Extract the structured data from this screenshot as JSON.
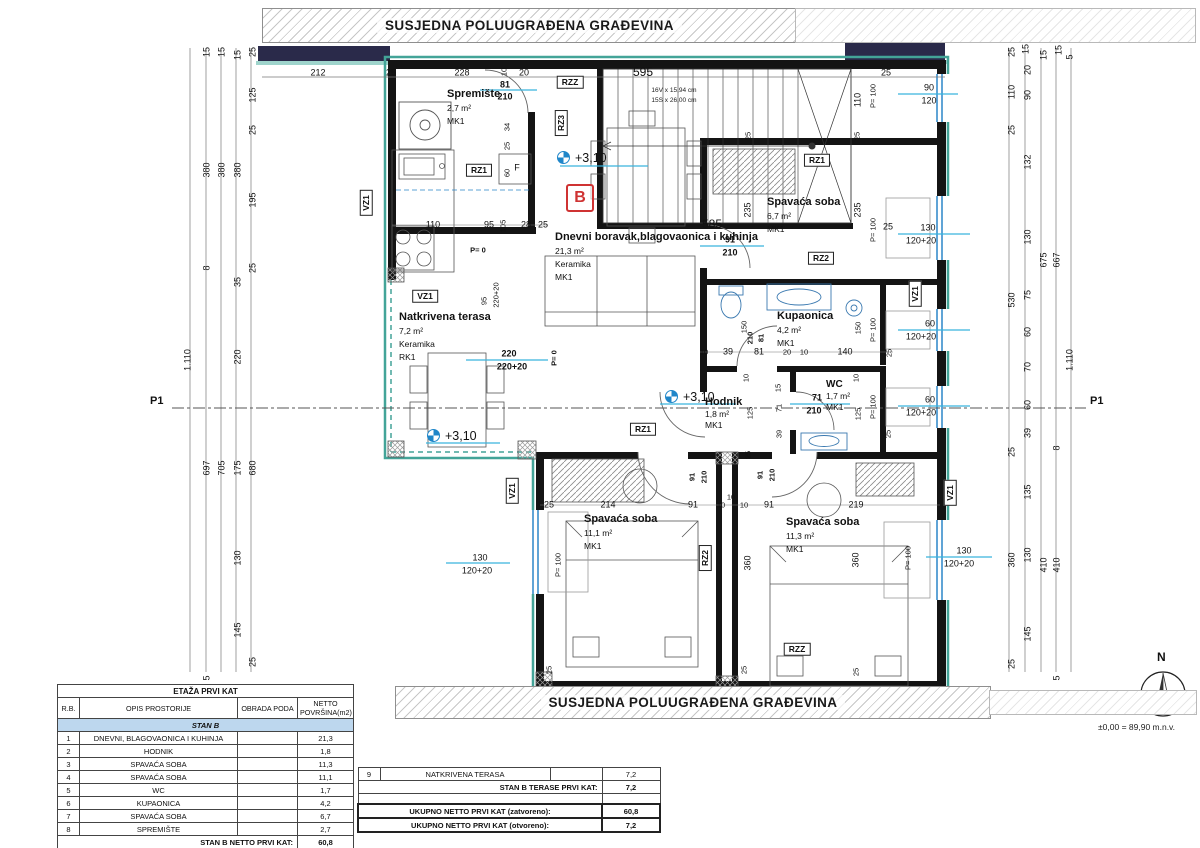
{
  "banners": {
    "top": "SUSJEDNA POLUUGRAĐENA GRAĐEVINA",
    "bottom": "SUSJEDNA POLUUGRAĐENA GRAĐEVINA"
  },
  "unit": {
    "letter": "B"
  },
  "section_marks": {
    "left": "P1",
    "right": "P1"
  },
  "levels": {
    "value": "+3,10"
  },
  "compass": {
    "label": "N",
    "elevation": "±0,00 = 89,90 m.n.v."
  },
  "stairs": {
    "flight_text1": "16V x 15,94 cm",
    "flight_text2": "15S x 26,00 cm"
  },
  "rooms": {
    "spremiste": {
      "name": "Spremište",
      "area": "2,7 m²",
      "mark": "MK1"
    },
    "dnevni": {
      "name": "Dnevni boravak,blagovaonica i kuhinja",
      "area": "21,3 m²",
      "finish": "Keramika",
      "mark": "MK1"
    },
    "spavaca67": {
      "name": "Spavaća soba",
      "area": "6,7 m²",
      "mark": "MK1"
    },
    "kupaonica": {
      "name": "Kupaonica",
      "area": "4,2 m²",
      "mark": "MK1"
    },
    "wc": {
      "name": "WC",
      "area": "1,7 m²",
      "mark": "MK1"
    },
    "hodnik": {
      "name": "Hodnik",
      "area": "1,8 m²",
      "mark": "MK1"
    },
    "spavaca111": {
      "name": "Spavaća soba",
      "area": "11,1 m²",
      "mark": "MK1"
    },
    "spavaca113": {
      "name": "Spavaća soba",
      "area": "11,3 m²",
      "mark": "MK1"
    },
    "terasa": {
      "name": "Natkrivena terasa",
      "area": "7,2 m²",
      "finish": "Keramika",
      "mark": "RK1"
    }
  },
  "tables": {
    "area_table": {
      "title": "ETAŽA PRVI KAT",
      "headers": [
        "R.B.",
        "OPIS PROSTORIJE",
        "OBRADA PODA",
        "NETTO POVRŠINA(m2)"
      ],
      "section_row": "STAN B",
      "rows": [
        [
          "1",
          "DNEVNI, BLAGOVAONICA I KUHINJA",
          "",
          "21,3"
        ],
        [
          "2",
          "HODNIK",
          "",
          "1,8"
        ],
        [
          "3",
          "SPAVAĆA SOBA",
          "",
          "11,3"
        ],
        [
          "4",
          "SPAVAĆA SOBA",
          "",
          "11,1"
        ],
        [
          "5",
          "WC",
          "",
          "1,7"
        ],
        [
          "6",
          "KUPAONICA",
          "",
          "4,2"
        ],
        [
          "7",
          "SPAVAĆA SOBA",
          "",
          "6,7"
        ],
        [
          "8",
          "SPREMIŠTE",
          "",
          "2,7"
        ]
      ],
      "total_label": "STAN B NETTO PRVI KAT:",
      "total_value": "60,8"
    },
    "terrace_table": {
      "row9": [
        "9",
        "NATKRIVENA TERASA",
        "",
        "7,2"
      ],
      "terase_label": "STAN B TERASE PRVI KAT:",
      "terase_value": "7,2",
      "zatvoreno_label": "UKUPNO NETTO PRVI KAT (zatvoreno):",
      "zatvoreno_value": "60,8",
      "otvoreno_label": "UKUPNO NETTO PRVI KAT (otvoreno):",
      "otvoreno_value": "7,2"
    }
  },
  "dims": [
    {
      "t": "212",
      "x": 318,
      "y": 73
    },
    {
      "t": "25",
      "x": 391,
      "y": 73
    },
    {
      "t": "228",
      "x": 462,
      "y": 73
    },
    {
      "t": "20",
      "x": 524,
      "y": 73
    },
    {
      "t": "595",
      "x": 643,
      "y": 72,
      "c": "lg"
    },
    {
      "t": "25",
      "x": 886,
      "y": 73
    },
    {
      "t": "90",
      "x": 929,
      "y": 88
    },
    {
      "t": "120",
      "x": 929,
      "y": 101
    },
    {
      "t": "110",
      "x": 858,
      "y": 100,
      "r": 1
    },
    {
      "t": "P= 100",
      "x": 873,
      "y": 96,
      "r": 1,
      "c": "sm"
    },
    {
      "t": "81",
      "x": 505,
      "y": 85,
      "b": 1
    },
    {
      "t": "210",
      "x": 505,
      "y": 97,
      "b": 1
    },
    {
      "t": "10",
      "x": 504,
      "y": 72,
      "r": 1,
      "c": "sm"
    },
    {
      "t": "34",
      "x": 507,
      "y": 127,
      "r": 1,
      "c": "sm"
    },
    {
      "t": "25",
      "x": 507,
      "y": 146,
      "r": 1,
      "c": "sm"
    },
    {
      "t": "60",
      "x": 507,
      "y": 173,
      "r": 1,
      "c": "sm"
    },
    {
      "t": "15",
      "x": 207,
      "y": 52,
      "r": 1
    },
    {
      "t": "15",
      "x": 222,
      "y": 52,
      "r": 1
    },
    {
      "t": "15",
      "x": 238,
      "y": 55,
      "r": 1
    },
    {
      "t": "25",
      "x": 253,
      "y": 52,
      "r": 1
    },
    {
      "t": "125",
      "x": 253,
      "y": 95,
      "r": 1
    },
    {
      "t": "25",
      "x": 253,
      "y": 130,
      "r": 1
    },
    {
      "t": "380",
      "x": 207,
      "y": 170,
      "r": 1
    },
    {
      "t": "380",
      "x": 222,
      "y": 170,
      "r": 1
    },
    {
      "t": "380",
      "x": 238,
      "y": 170,
      "r": 1
    },
    {
      "t": "195",
      "x": 253,
      "y": 200,
      "r": 1
    },
    {
      "t": "25",
      "x": 253,
      "y": 268,
      "r": 1
    },
    {
      "t": "8",
      "x": 207,
      "y": 268,
      "r": 1
    },
    {
      "t": "35",
      "x": 238,
      "y": 282,
      "r": 1
    },
    {
      "t": "220",
      "x": 238,
      "y": 357,
      "r": 1
    },
    {
      "t": "1.110",
      "x": 188,
      "y": 360,
      "r": 1
    },
    {
      "t": "697",
      "x": 207,
      "y": 468,
      "r": 1
    },
    {
      "t": "705",
      "x": 222,
      "y": 468,
      "r": 1
    },
    {
      "t": "175",
      "x": 238,
      "y": 468,
      "r": 1
    },
    {
      "t": "680",
      "x": 253,
      "y": 468,
      "r": 1
    },
    {
      "t": "130",
      "x": 238,
      "y": 558,
      "r": 1
    },
    {
      "t": "145",
      "x": 238,
      "y": 630,
      "r": 1
    },
    {
      "t": "25",
      "x": 253,
      "y": 662,
      "r": 1
    },
    {
      "t": "5",
      "x": 207,
      "y": 678,
      "r": 1
    },
    {
      "t": "25",
      "x": 1012,
      "y": 52,
      "r": 1
    },
    {
      "t": "15",
      "x": 1026,
      "y": 49,
      "r": 1
    },
    {
      "t": "20",
      "x": 1028,
      "y": 70,
      "r": 1
    },
    {
      "t": "15",
      "x": 1044,
      "y": 55,
      "r": 1
    },
    {
      "t": "15",
      "x": 1059,
      "y": 50,
      "r": 1
    },
    {
      "t": "5",
      "x": 1070,
      "y": 57,
      "r": 1
    },
    {
      "t": "110",
      "x": 1012,
      "y": 92,
      "r": 1
    },
    {
      "t": "90",
      "x": 1028,
      "y": 95,
      "r": 1
    },
    {
      "t": "25",
      "x": 1012,
      "y": 130,
      "r": 1
    },
    {
      "t": "132",
      "x": 1028,
      "y": 162,
      "r": 1
    },
    {
      "t": "130",
      "x": 1028,
      "y": 237,
      "r": 1
    },
    {
      "t": "675",
      "x": 1044,
      "y": 260,
      "r": 1
    },
    {
      "t": "667",
      "x": 1057,
      "y": 260,
      "r": 1
    },
    {
      "t": "530",
      "x": 1012,
      "y": 300,
      "r": 1
    },
    {
      "t": "75",
      "x": 1028,
      "y": 295,
      "r": 1
    },
    {
      "t": "60",
      "x": 1028,
      "y": 332,
      "r": 1
    },
    {
      "t": "70",
      "x": 1028,
      "y": 367,
      "r": 1
    },
    {
      "t": "60",
      "x": 1028,
      "y": 405,
      "r": 1
    },
    {
      "t": "1.110",
      "x": 1070,
      "y": 360,
      "r": 1
    },
    {
      "t": "39",
      "x": 1028,
      "y": 433,
      "r": 1
    },
    {
      "t": "25",
      "x": 1012,
      "y": 452,
      "r": 1
    },
    {
      "t": "8",
      "x": 1057,
      "y": 448,
      "r": 1
    },
    {
      "t": "135",
      "x": 1028,
      "y": 492,
      "r": 1
    },
    {
      "t": "360",
      "x": 1012,
      "y": 560,
      "r": 1
    },
    {
      "t": "130",
      "x": 1028,
      "y": 555,
      "r": 1
    },
    {
      "t": "410",
      "x": 1044,
      "y": 565,
      "r": 1
    },
    {
      "t": "410",
      "x": 1057,
      "y": 565,
      "r": 1
    },
    {
      "t": "145",
      "x": 1028,
      "y": 634,
      "r": 1
    },
    {
      "t": "25",
      "x": 1012,
      "y": 664,
      "r": 1
    },
    {
      "t": "5",
      "x": 1057,
      "y": 678,
      "r": 1
    },
    {
      "t": "110",
      "x": 433,
      "y": 225
    },
    {
      "t": "95",
      "x": 489,
      "y": 225
    },
    {
      "t": "105",
      "x": 503,
      "y": 226,
      "r": 1,
      "c": "sm"
    },
    {
      "t": "28",
      "x": 526,
      "y": 225
    },
    {
      "t": "25",
      "x": 543,
      "y": 225
    },
    {
      "t": "P= 0",
      "x": 478,
      "y": 250,
      "b": 1,
      "c": "sm"
    },
    {
      "t": "95",
      "x": 484,
      "y": 301,
      "r": 1,
      "c": "sm"
    },
    {
      "t": "220+20",
      "x": 496,
      "y": 295,
      "r": 1,
      "c": "sm"
    },
    {
      "t": "585",
      "x": 712,
      "y": 224,
      "c": "lg"
    },
    {
      "t": "91",
      "x": 730,
      "y": 240,
      "b": 1
    },
    {
      "t": "210",
      "x": 730,
      "y": 253,
      "b": 1
    },
    {
      "t": "25",
      "x": 748,
      "y": 136,
      "r": 1,
      "c": "sm"
    },
    {
      "t": "25",
      "x": 857,
      "y": 136,
      "r": 1,
      "c": "sm"
    },
    {
      "t": "235",
      "x": 748,
      "y": 210,
      "r": 1
    },
    {
      "t": "235",
      "x": 858,
      "y": 210,
      "r": 1
    },
    {
      "t": "P= 100",
      "x": 873,
      "y": 230,
      "r": 1,
      "c": "sm"
    },
    {
      "t": "25",
      "x": 888,
      "y": 227
    },
    {
      "t": "130",
      "x": 928,
      "y": 228
    },
    {
      "t": "120+20",
      "x": 921,
      "y": 241
    },
    {
      "t": "10",
      "x": 704,
      "y": 352,
      "c": "sm"
    },
    {
      "t": "39",
      "x": 728,
      "y": 352
    },
    {
      "t": "81",
      "x": 759,
      "y": 352
    },
    {
      "t": "20",
      "x": 787,
      "y": 352,
      "c": "sm"
    },
    {
      "t": "10",
      "x": 804,
      "y": 352,
      "c": "sm"
    },
    {
      "t": "140",
      "x": 845,
      "y": 352
    },
    {
      "t": "25",
      "x": 889,
      "y": 353,
      "r": 1,
      "c": "sm"
    },
    {
      "t": "150",
      "x": 744,
      "y": 327,
      "r": 1,
      "c": "sm"
    },
    {
      "t": "150",
      "x": 858,
      "y": 328,
      "r": 1,
      "c": "sm"
    },
    {
      "t": "210",
      "x": 750,
      "y": 338,
      "r": 1,
      "b": 1,
      "c": "sm"
    },
    {
      "t": "81",
      "x": 761,
      "y": 338,
      "r": 1,
      "b": 1,
      "c": "sm"
    },
    {
      "t": "P= 100",
      "x": 873,
      "y": 330,
      "r": 1,
      "c": "sm"
    },
    {
      "t": "60",
      "x": 930,
      "y": 324
    },
    {
      "t": "120+20",
      "x": 921,
      "y": 337
    },
    {
      "t": "10",
      "x": 746,
      "y": 378,
      "r": 1,
      "c": "sm"
    },
    {
      "t": "125",
      "x": 750,
      "y": 413,
      "r": 1,
      "c": "sm"
    },
    {
      "t": "15",
      "x": 778,
      "y": 388,
      "r": 1,
      "c": "sm"
    },
    {
      "t": "71",
      "x": 779,
      "y": 408,
      "r": 1,
      "c": "sm"
    },
    {
      "t": "39",
      "x": 779,
      "y": 434,
      "r": 1,
      "c": "sm"
    },
    {
      "t": "10",
      "x": 856,
      "y": 378,
      "r": 1,
      "c": "sm"
    },
    {
      "t": "125",
      "x": 858,
      "y": 414,
      "r": 1,
      "c": "sm"
    },
    {
      "t": "71",
      "x": 817,
      "y": 398,
      "b": 1
    },
    {
      "t": "210",
      "x": 814,
      "y": 411,
      "b": 1
    },
    {
      "t": "P= 100",
      "x": 873,
      "y": 407,
      "r": 1,
      "c": "sm"
    },
    {
      "t": "60",
      "x": 930,
      "y": 400
    },
    {
      "t": "120+20",
      "x": 921,
      "y": 413
    },
    {
      "t": "25",
      "x": 888,
      "y": 434,
      "r": 1,
      "c": "sm"
    },
    {
      "t": "91",
      "x": 692,
      "y": 477,
      "r": 1,
      "b": 1,
      "c": "sm"
    },
    {
      "t": "210",
      "x": 704,
      "y": 477,
      "r": 1,
      "b": 1,
      "c": "sm"
    },
    {
      "t": "91",
      "x": 760,
      "y": 475,
      "r": 1,
      "b": 1,
      "c": "sm"
    },
    {
      "t": "210",
      "x": 772,
      "y": 475,
      "r": 1,
      "b": 1,
      "c": "sm"
    },
    {
      "t": "25",
      "x": 748,
      "y": 455,
      "r": 1,
      "c": "sm"
    },
    {
      "t": "10",
      "x": 731,
      "y": 497,
      "c": "sm"
    },
    {
      "t": "25",
      "x": 549,
      "y": 505
    },
    {
      "t": "214",
      "x": 608,
      "y": 505
    },
    {
      "t": "91",
      "x": 693,
      "y": 505
    },
    {
      "t": "10",
      "x": 721,
      "y": 505,
      "c": "sm"
    },
    {
      "t": "10",
      "x": 744,
      "y": 505,
      "c": "sm"
    },
    {
      "t": "91",
      "x": 769,
      "y": 505
    },
    {
      "t": "219",
      "x": 856,
      "y": 505
    },
    {
      "t": "360",
      "x": 748,
      "y": 563,
      "r": 1
    },
    {
      "t": "360",
      "x": 856,
      "y": 560,
      "r": 1
    },
    {
      "t": "130",
      "x": 480,
      "y": 558
    },
    {
      "t": "120+20",
      "x": 477,
      "y": 571
    },
    {
      "t": "P= 100",
      "x": 558,
      "y": 565,
      "r": 1,
      "c": "sm"
    },
    {
      "t": "130",
      "x": 964,
      "y": 551
    },
    {
      "t": "120+20",
      "x": 959,
      "y": 564
    },
    {
      "t": "P= 100",
      "x": 908,
      "y": 558,
      "r": 1,
      "c": "sm"
    },
    {
      "t": "25",
      "x": 549,
      "y": 670,
      "r": 1,
      "c": "sm"
    },
    {
      "t": "25",
      "x": 744,
      "y": 670,
      "r": 1,
      "c": "sm"
    },
    {
      "t": "25",
      "x": 856,
      "y": 672,
      "r": 1,
      "c": "sm"
    },
    {
      "t": "220",
      "x": 509,
      "y": 354,
      "b": 1
    },
    {
      "t": "220+20",
      "x": 512,
      "y": 367,
      "b": 1
    },
    {
      "t": "P= 0",
      "x": 554,
      "y": 358,
      "r": 1,
      "b": 1,
      "c": "sm"
    },
    {
      "t": "RZZ",
      "x": 570,
      "y": 82,
      "c": "tag"
    },
    {
      "t": "RZ3",
      "x": 561,
      "y": 123,
      "c": "tagv"
    },
    {
      "t": "RZ1",
      "x": 479,
      "y": 170,
      "c": "tag"
    },
    {
      "t": "F",
      "x": 517,
      "y": 168
    },
    {
      "t": "RZ1",
      "x": 817,
      "y": 160,
      "c": "tag"
    },
    {
      "t": "RZ2",
      "x": 821,
      "y": 258,
      "c": "tag"
    },
    {
      "t": "RZ1",
      "x": 643,
      "y": 429,
      "c": "tag"
    },
    {
      "t": "RZ2",
      "x": 705,
      "y": 558,
      "c": "tagv"
    },
    {
      "t": "RZZ",
      "x": 797,
      "y": 649,
      "c": "tag"
    },
    {
      "t": "VZ1",
      "x": 366,
      "y": 203,
      "c": "tagv"
    },
    {
      "t": "VZ1",
      "x": 425,
      "y": 296,
      "c": "tag"
    },
    {
      "t": "VZ1",
      "x": 512,
      "y": 491,
      "c": "tagv"
    },
    {
      "t": "VZ1",
      "x": 915,
      "y": 294,
      "c": "tagv"
    },
    {
      "t": "VZ1",
      "x": 950,
      "y": 493,
      "c": "tagv"
    }
  ]
}
